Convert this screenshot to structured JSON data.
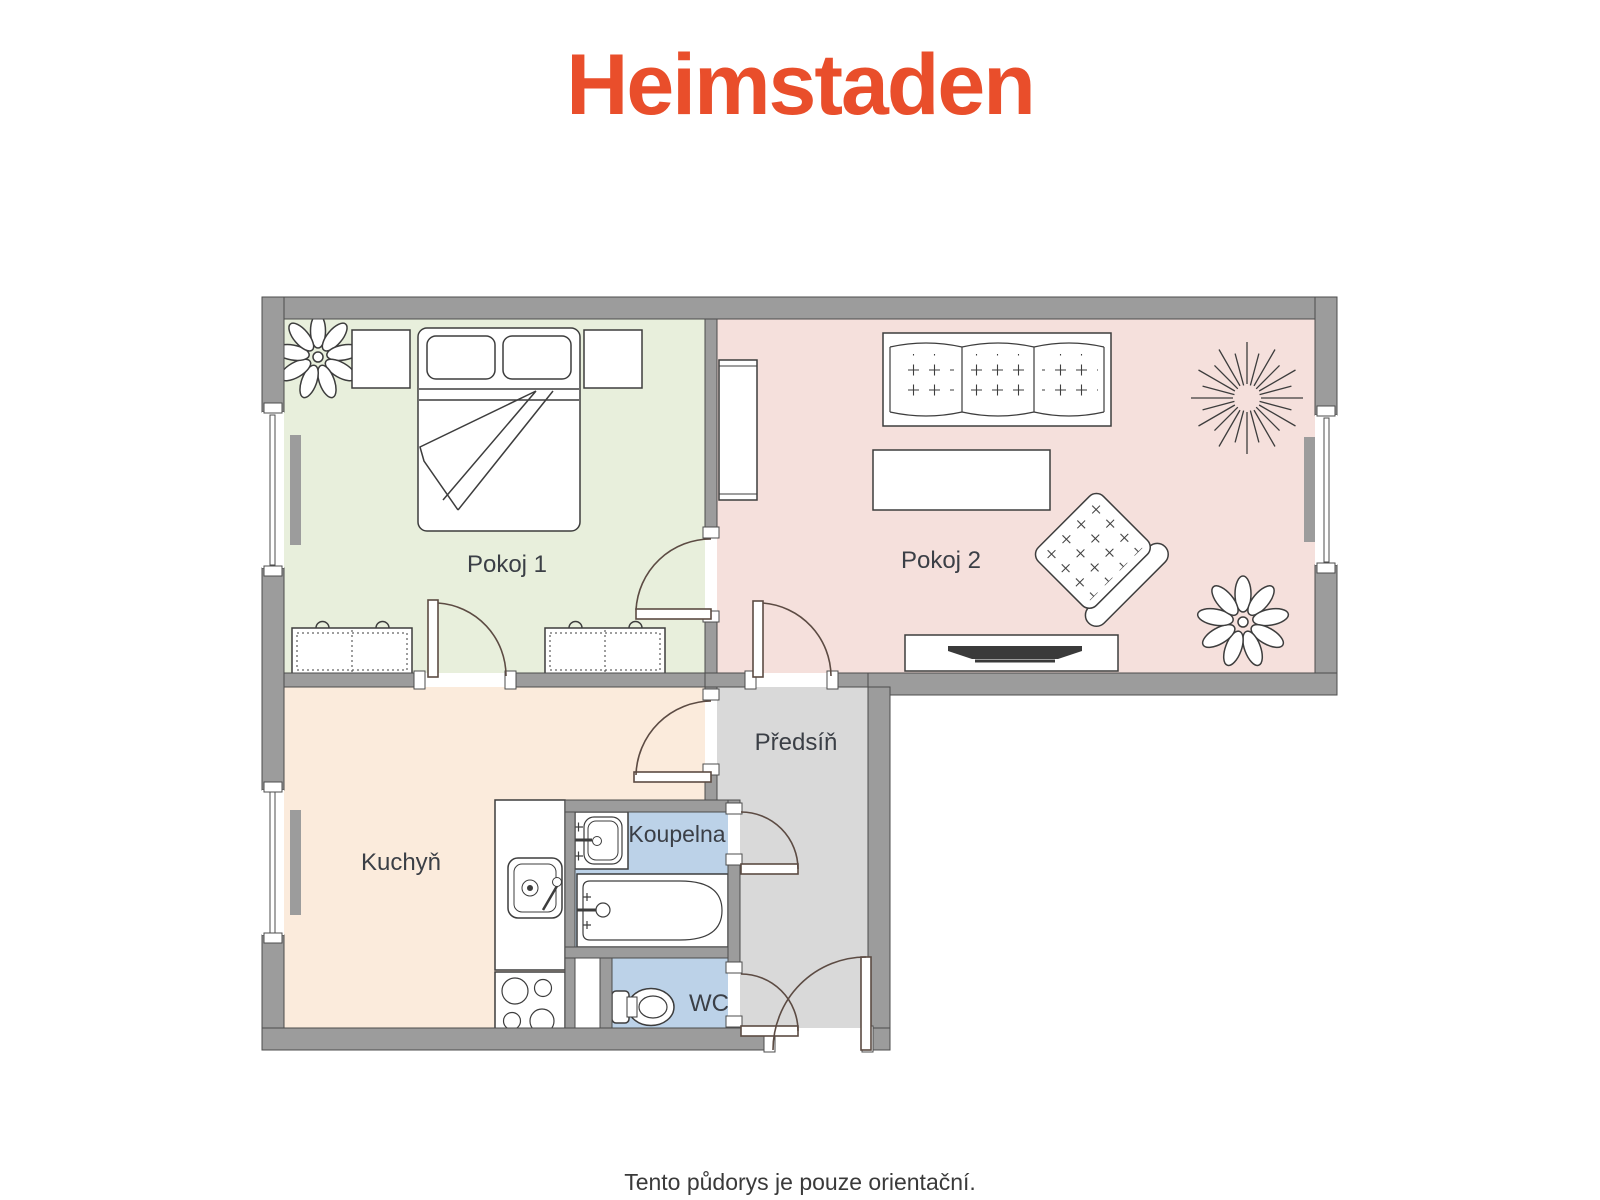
{
  "header": {
    "logo": "Heimstaden"
  },
  "footer": {
    "note": "Tento půdorys je pouze orientační."
  },
  "plan": {
    "rooms": {
      "pokoj1": {
        "label": "Pokoj 1"
      },
      "pokoj2": {
        "label": "Pokoj 2"
      },
      "kuchyn": {
        "label": "Kuchyň"
      },
      "predsin": {
        "label": "Předsíň"
      },
      "koupelna": {
        "label": "Koupelna"
      },
      "wc": {
        "label": "WC"
      }
    }
  },
  "colors": {
    "brand": "#E94E2B",
    "pokoj1_fill": "#E8EFDC",
    "pokoj2_fill": "#F5E0DC",
    "kuchyn_fill": "#FBEBDC",
    "predsin_fill": "#D9D9D9",
    "bath_fill": "#BCD2E8",
    "wall_fill": "#9C9C9C",
    "label_text": "#3B3F46",
    "footer_text": "#3A3A3A"
  }
}
